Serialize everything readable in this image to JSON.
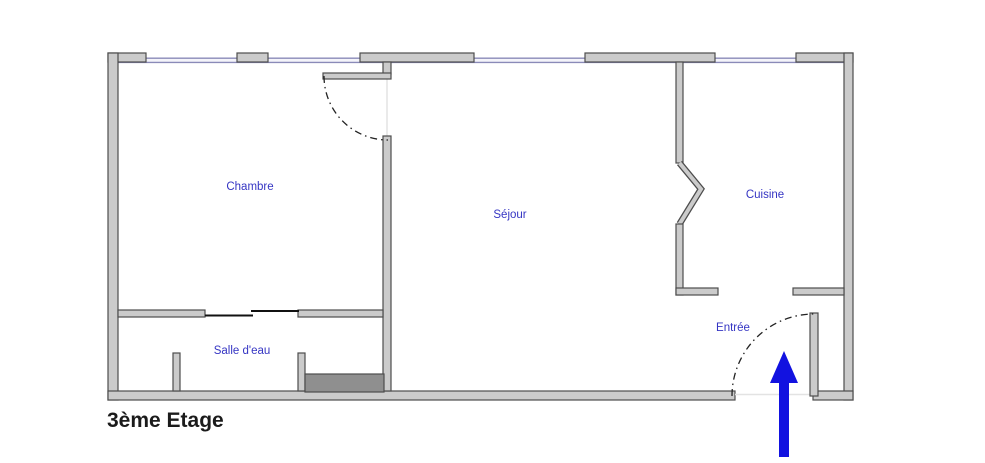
{
  "title": "3ème Etage",
  "rooms": [
    {
      "id": "chambre",
      "label": "Chambre"
    },
    {
      "id": "sejour",
      "label": "Séjour"
    },
    {
      "id": "cuisine",
      "label": "Cuisine"
    },
    {
      "id": "salle-deau",
      "label": "Salle d'eau"
    },
    {
      "id": "entree",
      "label": "Entrée"
    }
  ],
  "icons": {
    "entry_arrow": "up-arrow"
  },
  "colors": {
    "wall_fill": "#cbcbcb",
    "wall_border": "#4d4d4d",
    "window_line": "#8a8ab8",
    "window_fill": "#f4f4fa",
    "room_label": "#3535c3",
    "title": "#1b1b1b",
    "arrow": "#1212e0",
    "door_arc": "#222222",
    "slide_door": "#111111",
    "fixture_fill": "#8f8f8f",
    "threshold": "#e3e3e3"
  }
}
